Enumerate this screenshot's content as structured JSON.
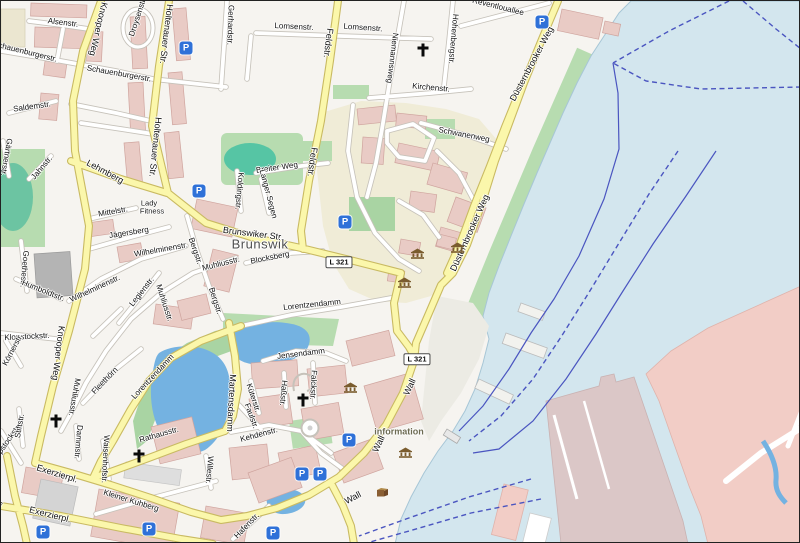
{
  "map": {
    "colors": {
      "sea": "#d3e6ee",
      "pond": "#74b2e1",
      "roadMajF": "#fbf7ab",
      "roadMajC": "#c9ba62",
      "roadMinC": "#c6c2ba",
      "building": "#e9cbc5",
      "park": "#b7dcb0",
      "pitch": "#56c5a4",
      "campus": "#f0ecd7",
      "harbor": "#f2cdc6",
      "pier": "#dbc7c7",
      "ferry": "#4a55c0",
      "sand": "#dbd2a4",
      "parking": "#2f71d8",
      "museum": "#7a5c2e"
    },
    "place_labels": [
      {
        "t": "Brunswik",
        "x": 259,
        "y": 243,
        "c": "#4e4e4e",
        "fs": 13
      }
    ],
    "poi_labels": [
      {
        "t": "information",
        "x": 398,
        "y": 431,
        "c": "#6d6b52",
        "fs": 9,
        "b": 1
      },
      {
        "t": "Lady",
        "x": 148,
        "y": 202,
        "c": "#1a1a1a",
        "fs": 7.5
      },
      {
        "t": "Fitness",
        "x": 151,
        "y": 210,
        "c": "#1a1a1a",
        "fs": 7.5
      }
    ],
    "road_refs": [
      {
        "t": "L 321",
        "x": 338,
        "y": 261
      },
      {
        "t": "L 321",
        "x": 416,
        "y": 358
      }
    ],
    "street_labels": [
      {
        "t": "Alsenstr.",
        "x": 62,
        "y": 22,
        "r": 7
      },
      {
        "t": "Schauenburgerstr.",
        "x": 24,
        "y": 51,
        "r": 14
      },
      {
        "t": "Schauenburgerstr.",
        "x": 118,
        "y": 73,
        "r": 10
      },
      {
        "t": "Droysenstr.",
        "x": 137,
        "y": 16,
        "r": -72
      },
      {
        "t": "Knooper Weg",
        "x": 97,
        "y": 28,
        "r": 103,
        "fs": 9
      },
      {
        "t": "Knooper Weg",
        "x": 57,
        "y": 352,
        "r": 97,
        "fs": 9
      },
      {
        "t": "Holtenauer Str.",
        "x": 165,
        "y": 33,
        "r": 97,
        "fs": 9
      },
      {
        "t": "Holtenauer Str.",
        "x": 154,
        "y": 146,
        "r": 96,
        "fs": 9
      },
      {
        "t": "Gerhardstr.",
        "x": 229,
        "y": 24,
        "r": 92
      },
      {
        "t": "Lomsenstr.",
        "x": 293,
        "y": 26,
        "r": 3
      },
      {
        "t": "Lomsenstr.",
        "x": 362,
        "y": 27,
        "r": 4
      },
      {
        "t": "Niemannsweg",
        "x": 391,
        "y": 57,
        "r": 97
      },
      {
        "t": "Kirchenstr.",
        "x": 430,
        "y": 87,
        "r": 5
      },
      {
        "t": "Hohenbergstr.",
        "x": 452,
        "y": 38,
        "r": 95
      },
      {
        "t": "Reventlouallee",
        "x": 497,
        "y": 6,
        "r": 14
      },
      {
        "t": "Schwanenweg",
        "x": 463,
        "y": 134,
        "r": 11
      },
      {
        "t": "Düsternbrooker Weg",
        "x": 531,
        "y": 63,
        "r": -62,
        "fs": 9
      },
      {
        "t": "Düsternbrooker Weg",
        "x": 469,
        "y": 232,
        "r": -66,
        "fs": 9
      },
      {
        "t": "Lehmberg",
        "x": 104,
        "y": 171,
        "r": 28,
        "fs": 9
      },
      {
        "t": "Mittelstr.",
        "x": 112,
        "y": 211,
        "r": -10
      },
      {
        "t": "Jägersberg",
        "x": 128,
        "y": 232,
        "r": -9
      },
      {
        "t": "Brunswiker Str.",
        "x": 252,
        "y": 233,
        "r": 7,
        "fs": 9
      },
      {
        "t": "Blocksberg",
        "x": 269,
        "y": 257,
        "r": -11
      },
      {
        "t": "Wilhelminenstr.",
        "x": 160,
        "y": 249,
        "r": -10
      },
      {
        "t": "Wilhelminenstr.",
        "x": 94,
        "y": 288,
        "r": -25
      },
      {
        "t": "Muhliusstr.",
        "x": 220,
        "y": 263,
        "r": -14
      },
      {
        "t": "Muhliusstr.",
        "x": 163,
        "y": 302,
        "r": 72
      },
      {
        "t": "Muhliusstr.",
        "x": 73,
        "y": 396,
        "r": 100
      },
      {
        "t": "Bergstr.",
        "x": 194,
        "y": 250,
        "r": 71
      },
      {
        "t": "Bergstr.",
        "x": 214,
        "y": 300,
        "r": 72
      },
      {
        "t": "Legienstr.",
        "x": 141,
        "y": 291,
        "r": -52
      },
      {
        "t": "Goethestr.",
        "x": 23,
        "y": 268,
        "r": 95
      },
      {
        "t": "Humboldtstr.",
        "x": 42,
        "y": 290,
        "r": 22
      },
      {
        "t": "Jahnstr.",
        "x": 41,
        "y": 167,
        "r": -50
      },
      {
        "t": "Gärtnerstr.",
        "x": 5,
        "y": 156,
        "r": 100
      },
      {
        "t": "Saldemstr.",
        "x": 31,
        "y": 106,
        "r": -8
      },
      {
        "t": "Klopstockstr.",
        "x": 26,
        "y": 336,
        "r": -3
      },
      {
        "t": "Klopstockstr.",
        "x": 5,
        "y": 443,
        "r": -55
      },
      {
        "t": "Körnerstr.",
        "x": 12,
        "y": 349,
        "r": -62
      },
      {
        "t": "Stiftstr.",
        "x": 19,
        "y": 425,
        "r": -80
      },
      {
        "t": "Fleethörn",
        "x": 104,
        "y": 380,
        "r": -46
      },
      {
        "t": "Lorentzendamm",
        "x": 311,
        "y": 304,
        "r": -6
      },
      {
        "t": "Lorentzendamm",
        "x": 152,
        "y": 376,
        "r": -47
      },
      {
        "t": "Dammstr.",
        "x": 77,
        "y": 441,
        "r": 95
      },
      {
        "t": "Waisenhofstr.",
        "x": 104,
        "y": 458,
        "r": 93
      },
      {
        "t": "Exerzierpl.",
        "x": 56,
        "y": 473,
        "r": 17,
        "fs": 9
      },
      {
        "t": "Exerzierpl.",
        "x": 49,
        "y": 514,
        "r": 14,
        "fs": 9
      },
      {
        "t": "Schützenwall",
        "x": -13,
        "y": 520,
        "r": -55
      },
      {
        "t": "Kleiner Kuhberg",
        "x": 130,
        "y": 500,
        "r": 17
      },
      {
        "t": "Willestr.",
        "x": 208,
        "y": 469,
        "r": 95
      },
      {
        "t": "Kehdenstr.",
        "x": 258,
        "y": 434,
        "r": -15
      },
      {
        "t": "Küterstr.",
        "x": 252,
        "y": 397,
        "r": 72
      },
      {
        "t": "Haßstr.",
        "x": 282,
        "y": 392,
        "r": 95
      },
      {
        "t": "Falckstr.",
        "x": 312,
        "y": 384,
        "r": 93
      },
      {
        "t": "Faulstr.",
        "x": 250,
        "y": 415,
        "r": 70
      },
      {
        "t": "Hafenstr.",
        "x": 246,
        "y": 525,
        "r": -46
      },
      {
        "t": "Jensendamm",
        "x": 300,
        "y": 353,
        "r": -7
      },
      {
        "t": "Martensdamm",
        "x": 230,
        "y": 402,
        "r": 93,
        "fs": 9
      },
      {
        "t": "Rathausstr.",
        "x": 158,
        "y": 434,
        "r": -16
      },
      {
        "t": "Breiter Weg",
        "x": 276,
        "y": 167,
        "r": -8
      },
      {
        "t": "Langer Segen",
        "x": 267,
        "y": 193,
        "r": 75
      },
      {
        "t": "Koldingstr.",
        "x": 238,
        "y": 190,
        "r": 95
      },
      {
        "t": "Feldstr.",
        "x": 327,
        "y": 42,
        "r": 97,
        "fs": 9
      },
      {
        "t": "Feldstr.",
        "x": 311,
        "y": 161,
        "r": 98,
        "fs": 9
      },
      {
        "t": "Wall",
        "x": 409,
        "y": 386,
        "r": -65,
        "fs": 9
      },
      {
        "t": "Wall",
        "x": 378,
        "y": 443,
        "r": -65,
        "fs": 9
      },
      {
        "t": "Wall",
        "x": 352,
        "y": 497,
        "r": -28,
        "fs": 9
      }
    ],
    "icons": {
      "parking_glyph": "P",
      "parking": [
        {
          "x": 185,
          "y": 47
        },
        {
          "x": 541,
          "y": 21
        },
        {
          "x": 198,
          "y": 190
        },
        {
          "x": 344,
          "y": 221
        },
        {
          "x": 348,
          "y": 439
        },
        {
          "x": 301,
          "y": 473
        },
        {
          "x": 319,
          "y": 473
        },
        {
          "x": 272,
          "y": 532
        },
        {
          "x": 42,
          "y": 531
        },
        {
          "x": 148,
          "y": 528
        }
      ],
      "museum": [
        {
          "x": 409,
          "y": 247
        },
        {
          "x": 449,
          "y": 241
        },
        {
          "x": 396,
          "y": 276
        },
        {
          "x": 342,
          "y": 381
        },
        {
          "x": 397,
          "y": 446
        }
      ],
      "church": [
        {
          "x": 422,
          "y": 49
        },
        {
          "x": 55,
          "y": 420
        },
        {
          "x": 302,
          "y": 399
        },
        {
          "x": 138,
          "y": 455
        }
      ],
      "artwork": [
        {
          "x": 374,
          "y": 485
        }
      ]
    }
  }
}
